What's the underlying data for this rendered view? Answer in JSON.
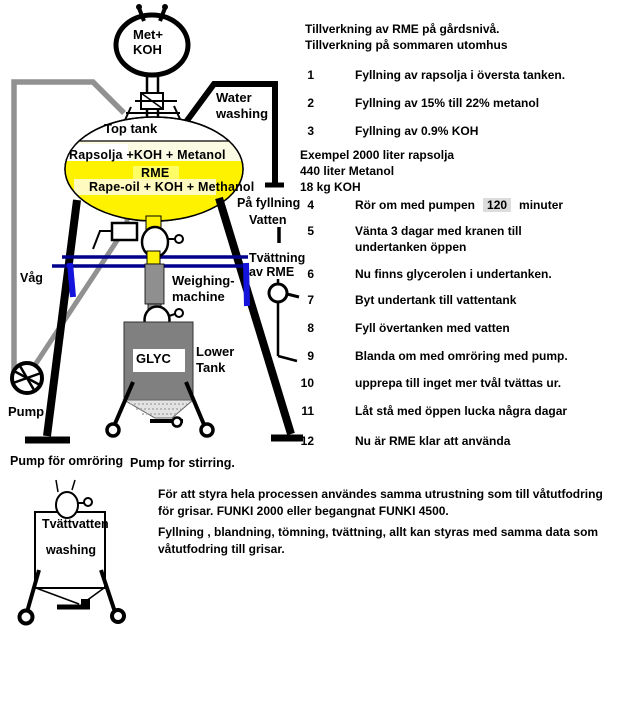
{
  "instructions": {
    "title": "Tillverkning av RME på gårdsnivå.\nTillverkning på sommaren utomhus",
    "steps": [
      {
        "num": "1",
        "text": "Fyllning av rapsolja i översta tanken."
      },
      {
        "num": "2",
        "text": "Fyllning av 15% till 22% metanol"
      },
      {
        "num": "3",
        "text": "Fyllning av 0.9% KOH"
      },
      {
        "num": "4",
        "pre": "Rör om med pumpen",
        "mid": "120",
        "post": "minuter"
      },
      {
        "num": "5",
        "text": "Vänta 3 dagar med kranen till\nundertanken öppen"
      },
      {
        "num": "6",
        "text": "Nu finns glycerolen i undertanken."
      },
      {
        "num": "7",
        "text": "Byt  undertank till vattentank"
      },
      {
        "num": "8",
        "text": "Fyll övertanken med vatten"
      },
      {
        "num": "9",
        "text": "Blanda om med omröring med pump."
      },
      {
        "num": "10",
        "text": "upprepa till inget mer tvål tvättas ur."
      },
      {
        "num": "11",
        "text": "Låt stå med öppen lucka några dagar"
      },
      {
        "num": "12",
        "text": "Nu är RME klar att använda"
      }
    ],
    "example": "Exempel  2000 liter rapsolja\n440 liter Metanol\n18 kg KOH"
  },
  "diagram": {
    "met_koh": "Met+\nKOH",
    "top_tank": "Top tank",
    "mix_line1": "Rapsolja +KOH + Metanol",
    "rme": "RME",
    "mix_line2": "Rape-oil + KOH + Methanol",
    "water_washing": "Water\nwashing",
    "pa_fyllning": "På fyllning",
    "vatten": "Vatten",
    "tvattning": "Tvättning\nav RME",
    "vag": "Våg",
    "weighing": "Weighing-\nmachine",
    "glyc": "GLYC",
    "lower_tank": "Lower\nTank",
    "pump": "Pump",
    "pump_label_sv": "Pump för omröring",
    "pump_label_en": "Pump for stirring.",
    "wash_tank_line1": "Tvättvatten",
    "wash_tank_line2": "washing"
  },
  "footer": {
    "para1": "För att styra hela processen användes samma utrustning som till våtutfodring\nför grisar.  FUNKI 2000 eller begangnat FUNKI 4500.",
    "para2": "Fyllning , blandning, tömning, tvättning,  allt kan styras med samma data som\nvåtutfodring till grisar."
  },
  "colors": {
    "tank_yellow": "#fff200",
    "frame_navy": "#00008b",
    "hook_blue": "#1414dd",
    "pipe_gray": "#919191",
    "tank_gray": "#808080"
  }
}
